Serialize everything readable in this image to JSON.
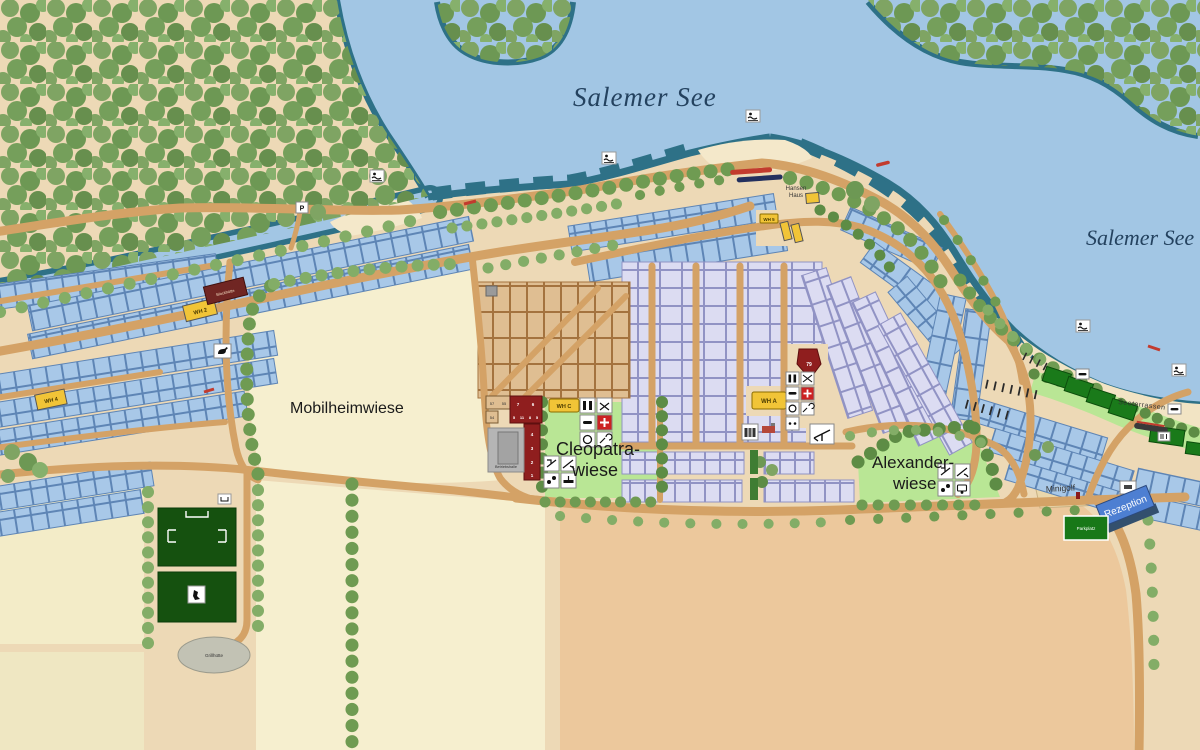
{
  "lake": {
    "label_center": "Salemer See",
    "label_right": "Salemer See"
  },
  "areas": {
    "mobilheimwiese": "Mobilheimwiese",
    "cleopatra_line1": "Cleopatra-",
    "cleopatra_line2": "wiese",
    "alexander_line1": "Alexander-",
    "alexander_line2": "wiese",
    "seeterrassen": "Seeterrassen",
    "minigolf": "Minigolf"
  },
  "buildings": {
    "rezeption": "Rezeption",
    "parkplatz": "Parkplatz",
    "hansen_line1": "Hansen",
    "hansen_line2": "Haus",
    "wh2": "WH 2",
    "wh4": "WH 4",
    "wh5": "WH 5",
    "wha": "WH A",
    "whc": "WH C",
    "blockhuette": "Blockhütte",
    "betriebshalle": "Betriebshalle",
    "grillhuette": "Grillhütte",
    "pentagon_number": "79",
    "red_units_row1": [
      "7",
      "6"
    ],
    "red_units_row2": [
      "5",
      "11",
      "8",
      "5"
    ],
    "red_units_column": [
      "4",
      "3",
      "2",
      "1"
    ],
    "tan_units": [
      "57",
      "55",
      "54"
    ]
  },
  "signs": {
    "parking_p": "P"
  },
  "plot_zones": [
    {
      "zone": "left-shore-rows",
      "numbers": "302-545"
    },
    {
      "zone": "main-road-rows",
      "numbers": "340-478"
    },
    {
      "zone": "north-curve-rows",
      "numbers": "195-260"
    },
    {
      "zone": "east-curve-rows",
      "numbers": "88-160"
    },
    {
      "zone": "central-grid",
      "numbers": "100-260"
    },
    {
      "zone": "central-grid-south-rows",
      "numbers": "1-33"
    },
    {
      "zone": "mobile-home-grid",
      "numbers": "1-57"
    }
  ],
  "colors": {
    "water": "#a2c6e4",
    "shore_dark": "#2e7187",
    "land": "#edd9b6",
    "beach": "#f4e8ca",
    "road": "#d4a266",
    "cream_field": "#f6efcf",
    "orange_field": "#ecc89c",
    "blue_plot": "#a8c8e8",
    "lavender_plot": "#dcdcf2",
    "tan_plot": "#dfbe92",
    "meadow": "#b9e695",
    "sports_green": "#15510f",
    "building_yellow": "#f1c437",
    "building_red": "#8f1e1e",
    "rezeption_blue": "#4d7fd2",
    "dark_green_building": "#1a7a1a"
  }
}
